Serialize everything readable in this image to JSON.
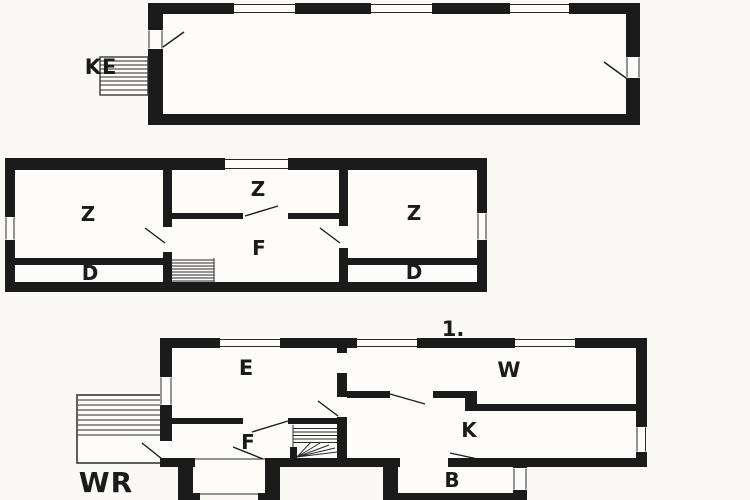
{
  "drawing": {
    "type": "floor-plan",
    "colors": {
      "wall": "#1b1b1b",
      "background": "#faf9f6",
      "interior": "#fdfcf9",
      "line": "#2a2a2a",
      "label": "#1b1b1b"
    },
    "floors": {
      "attic": {
        "entrance_stair_label": "KE"
      },
      "upper": {
        "room_z_left": "Z",
        "room_z_middle": "Z",
        "room_z_right": "Z",
        "room_f": "F",
        "room_d_left": "D",
        "room_d_right": "D"
      },
      "ground": {
        "floor_number_label": "1.",
        "room_e": "E",
        "room_w": "W",
        "room_f": "F",
        "room_k": "K",
        "room_b": "B",
        "terrace_label": "WR"
      }
    }
  }
}
